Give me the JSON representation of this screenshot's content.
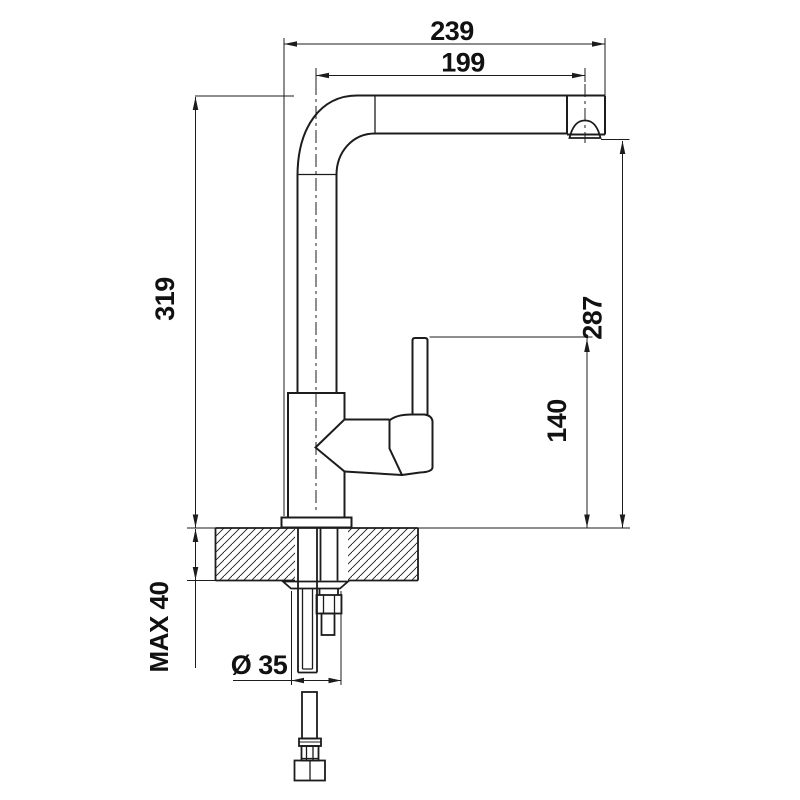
{
  "drawing": {
    "background": "#ffffff",
    "line_color": "#1c1c1c",
    "dimensions": {
      "total_projection": "239",
      "spout_reach": "199",
      "total_height": "319",
      "outlet_height": "287",
      "handle_height": "140",
      "max_mounting_thickness": "MAX 40",
      "hole_diameter": "Ø 35"
    }
  }
}
